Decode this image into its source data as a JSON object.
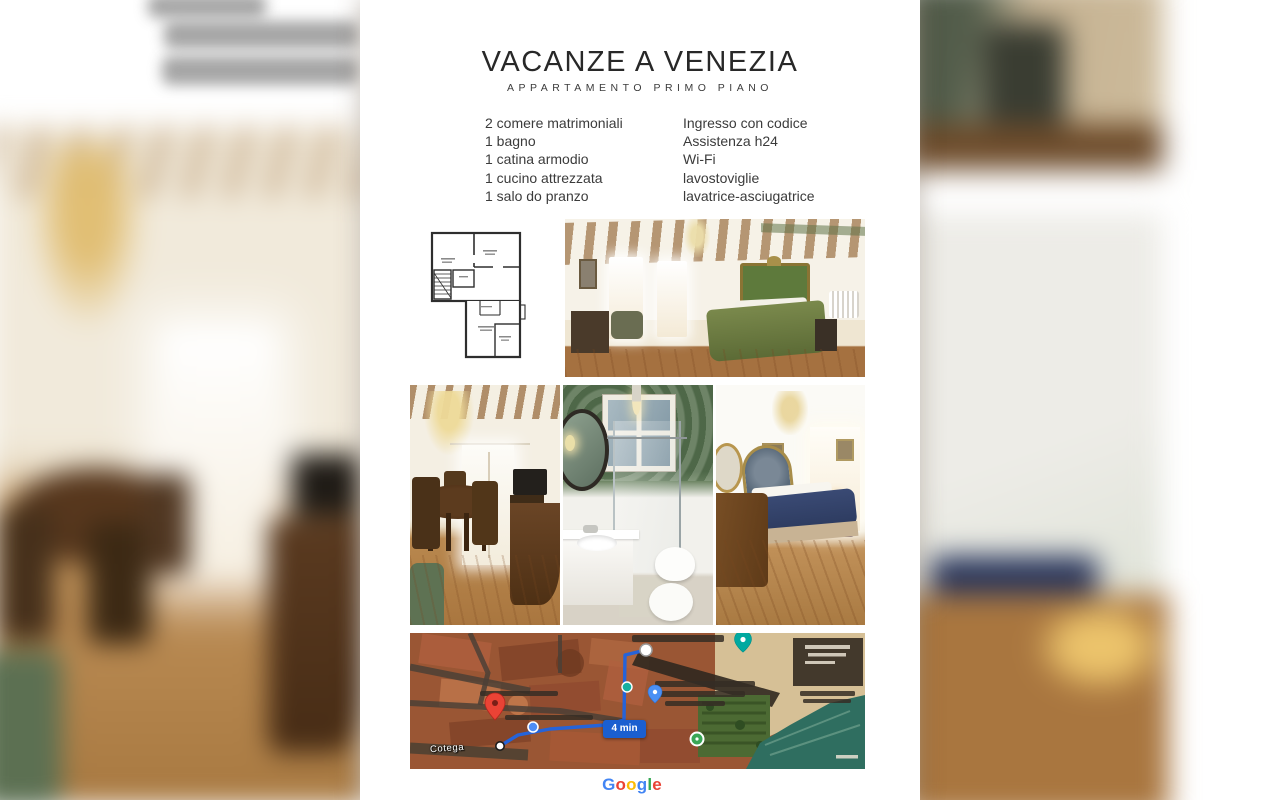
{
  "flyer": {
    "title": "VACANZE A VENEZIA",
    "subtitle": "APPARTAMENTO PRIMO PIANO",
    "features_left": [
      "2 comere matrimoniali",
      "1 bagno",
      "1 catina armodio",
      "1 cucino attrezzata",
      "1 salo do pranzo"
    ],
    "features_right": [
      "Ingresso con codice",
      "Assistenza h24",
      "Wi-Fi",
      "lavostoviglie",
      "lavatrice-asciugatrice"
    ]
  },
  "images": {
    "floorplan": "apartment-floor-plan-drawing",
    "photo_main_bedroom": "bedroom-with-green-bed-and-beamed-ceiling",
    "photo_dining": "dining-room-with-glass-chandelier",
    "photo_bathroom": "bathroom-with-glass-shower",
    "photo_second_bedroom": "bedroom-with-blue-blanket",
    "background_left": "blurred-enlarged-dining-room-photo",
    "background_right": "blurred-enlarged-bedroom-photo"
  },
  "map": {
    "duration_badge": "4 min",
    "street_label": "Cotega",
    "marker_icons": [
      "red-pin-icon",
      "route-start-dot-icon",
      "route-end-dot-icon",
      "teal-pin-icon",
      "teal-dot-icon",
      "blue-pin-icon",
      "blue-dot-icon",
      "green-circle-icon"
    ],
    "colors": {
      "route_blue": "#2563d9",
      "badge_blue": "#1b5fd0",
      "water_teal": "#2f6e60",
      "roof_red": "#9a5634",
      "plaza_tan": "#d6c096"
    }
  },
  "google": {
    "letters": [
      {
        "ch": "G",
        "color": "#4285F4"
      },
      {
        "ch": "o",
        "color": "#EA4335"
      },
      {
        "ch": "o",
        "color": "#FBBC05"
      },
      {
        "ch": "g",
        "color": "#4285F4"
      },
      {
        "ch": "l",
        "color": "#34A853"
      },
      {
        "ch": "e",
        "color": "#EA4335"
      }
    ]
  },
  "colors": {
    "title_text": "#282828",
    "body_text": "#3b3b3b",
    "flyer_background": "#ffffff"
  }
}
